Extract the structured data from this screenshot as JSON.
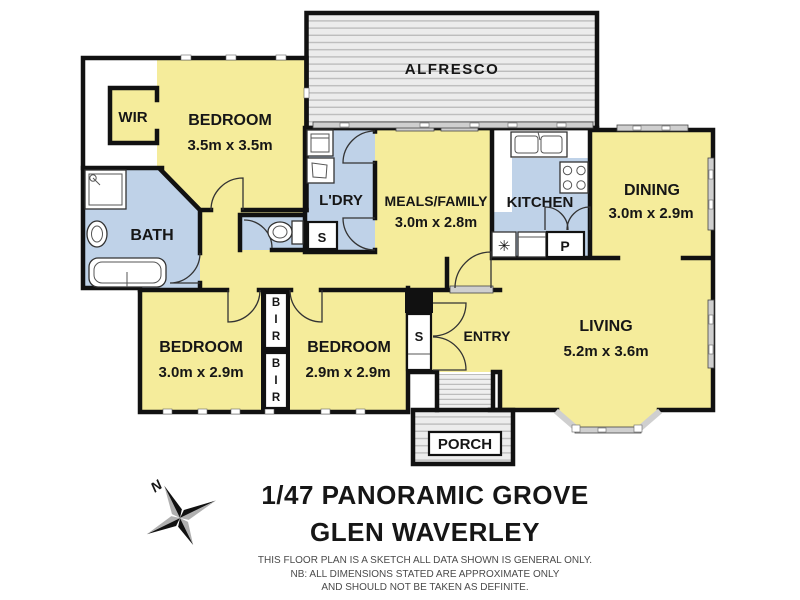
{
  "title": {
    "line1": "1/47 PANORAMIC GROVE",
    "line2": "GLEN WAVERLEY"
  },
  "disclaimer": {
    "line1": "THIS FLOOR PLAN IS A SKETCH ALL DATA SHOWN IS GENERAL ONLY.",
    "line2": "NB: ALL DIMENSIONS STATED ARE APPROXIMATE ONLY",
    "line3": "AND SHOULD NOT BE TAKEN AS DEFINITE."
  },
  "compass": {
    "north_label": "N"
  },
  "rooms": {
    "alfresco": {
      "label": "ALFRESCO"
    },
    "wir": {
      "label": "WIR"
    },
    "bedroom_main": {
      "label": "BEDROOM",
      "dims": "3.5m x 3.5m"
    },
    "bath": {
      "label": "BATH"
    },
    "laundry": {
      "label": "L'DRY"
    },
    "meals_family": {
      "label": "MEALS/FAMILY",
      "dims": "3.0m x 2.8m"
    },
    "kitchen": {
      "label": "KITCHEN"
    },
    "dining": {
      "label": "DINING",
      "dims": "3.0m x 2.9m"
    },
    "living": {
      "label": "LIVING",
      "dims": "5.2m x 3.6m"
    },
    "entry": {
      "label": "ENTRY"
    },
    "porch": {
      "label": "PORCH"
    },
    "bedroom_three": {
      "label": "BEDROOM",
      "dims": "3.0m x 2.9m"
    },
    "bedroom_two": {
      "label": "BEDROOM",
      "dims": "2.9m x 2.9m"
    }
  },
  "closets": {
    "store_one": "S",
    "store_two": "S",
    "pantry": "P",
    "dishwasher_symbol": "✳",
    "bir_top": [
      "B",
      "I",
      "R"
    ],
    "bir_bottom": [
      "B",
      "I",
      "R"
    ]
  },
  "colors": {
    "room_yellow": "#f5ec9b",
    "wet_blue": "#bfd2e8",
    "wall_black": "#111111",
    "deck_gray": "#ececec",
    "deck_line": "#bdbdbd",
    "window_gray": "#cfcfcf"
  }
}
